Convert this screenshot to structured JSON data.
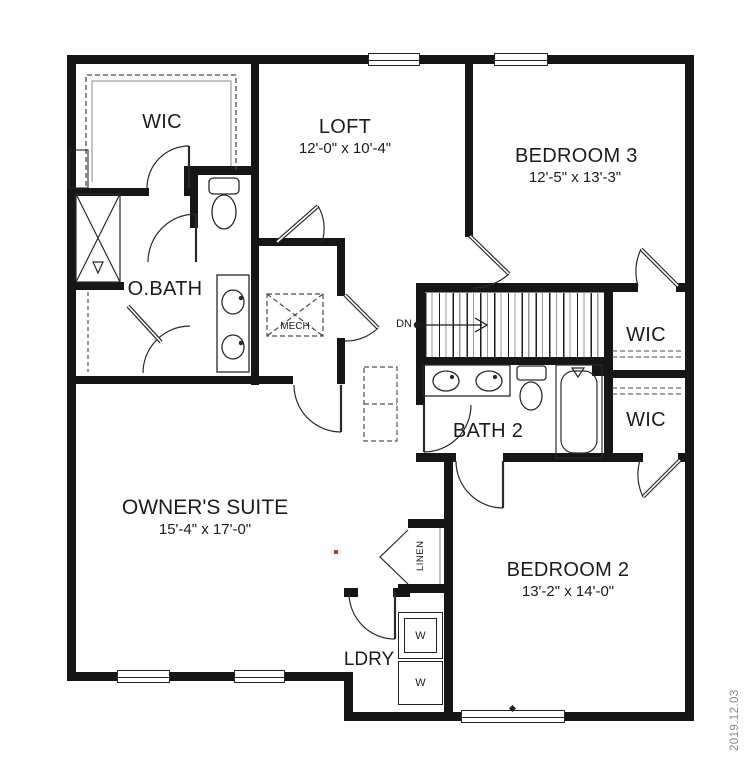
{
  "meta": {
    "date_stamp": "2019.12.03"
  },
  "colors": {
    "wall": "#161616",
    "text": "#1c1c1c",
    "stamp": "#8a8a8a",
    "accent_dot": "#c23b31"
  },
  "rooms": {
    "wic_owner": {
      "label": "WIC"
    },
    "loft": {
      "label": "LOFT",
      "dims": "12'-0\" x 10'-4\""
    },
    "bedroom3": {
      "label": "BEDROOM 3",
      "dims": "12'-5\" x 13'-3\""
    },
    "obath": {
      "label": "O.BATH"
    },
    "mech": {
      "label": "MECH"
    },
    "stairs": {
      "label": "DN"
    },
    "wic_right_upper": {
      "label": "WIC"
    },
    "wic_right_lower": {
      "label": "WIC"
    },
    "bath2": {
      "label": "BATH 2"
    },
    "owners_suite": {
      "label": "OWNER'S SUITE",
      "dims": "15'-4\" x 17'-0\""
    },
    "bedroom2": {
      "label": "BEDROOM 2",
      "dims": "13'-2\" x 14'-0\""
    },
    "laundry": {
      "label": "LDRY"
    },
    "linen": {
      "label": "LINEN"
    },
    "lin_closet": {
      "label": "LIN."
    }
  },
  "appliances": {
    "washer_top": "W",
    "washer_bottom": "W"
  },
  "fixture_icons": [
    "toilet-icon",
    "double-vanity-sink-icon",
    "bathtub-icon",
    "shower-icon",
    "stacked-washer-icon",
    "stair-treads-icon",
    "down-arrow-icon",
    "door-swing-icon"
  ]
}
